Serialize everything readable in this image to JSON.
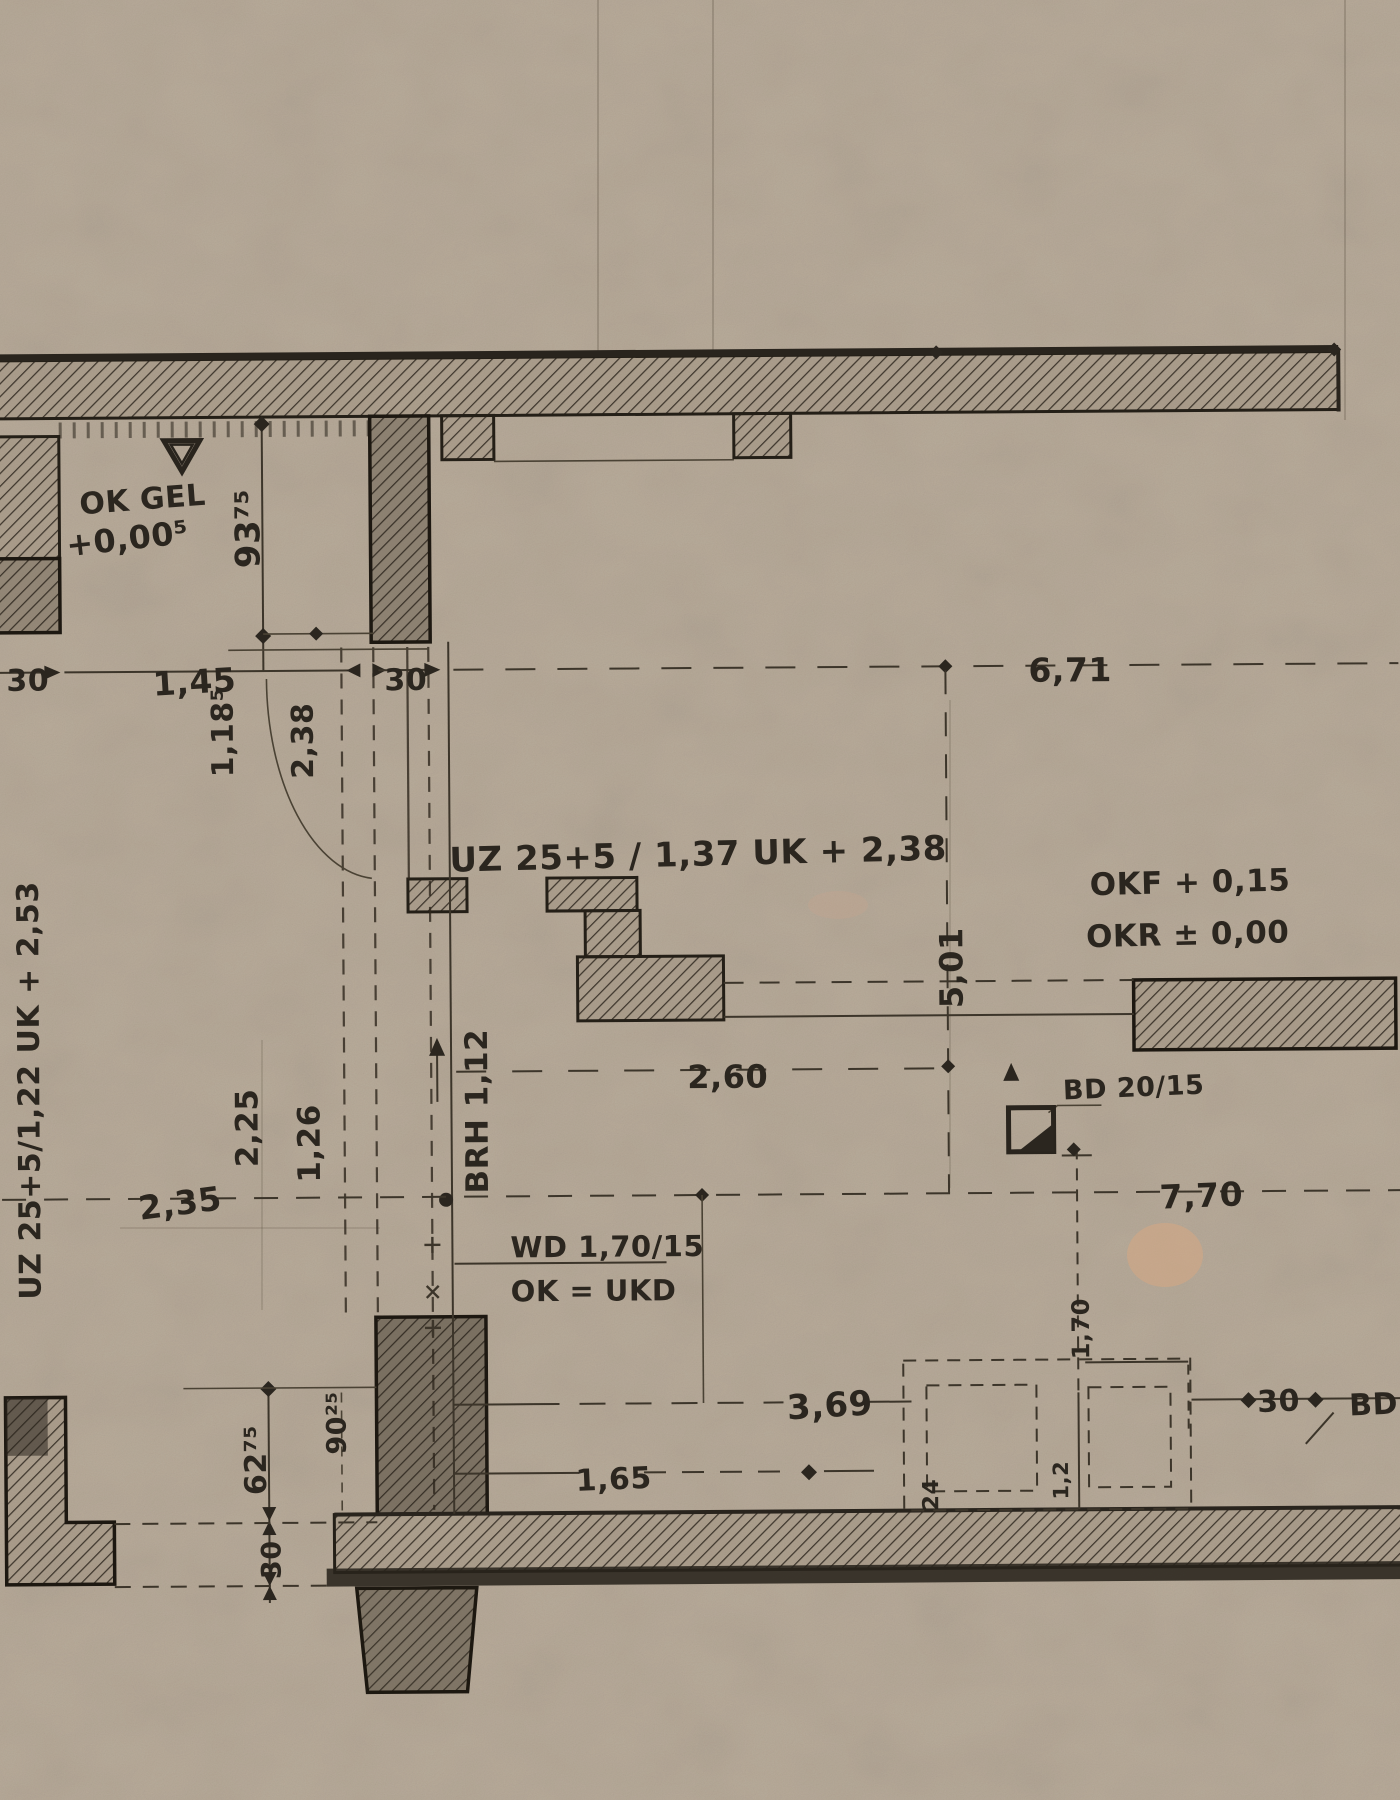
{
  "colors": {
    "paper": "#b6a896",
    "ink": "#29241d",
    "dim_line": "#3c352a",
    "stain": "#dda87f"
  },
  "labels": {
    "levels": {
      "ok_gel": "OK GEL",
      "zero": "+0,00⁵",
      "okf": "OKF + 0,15",
      "okr": "OKR ± 0,00"
    },
    "beams": {
      "uz_top": "UZ 25+5 / 1,37  UK + 2,38",
      "uz_left": "UZ 25+5/1,22  UK + 2,53",
      "wd": "WD 1,70/15",
      "wd_ok": "OK = UKD",
      "bd": "BD 20/15",
      "bd_edge": "BD"
    },
    "dims": {
      "v93": "93⁷⁵",
      "h30_left": "30",
      "h145": "1,45",
      "h30_mid": "30",
      "h671": "6,71",
      "v118": "1,18⁵",
      "v238": "2,38",
      "v501": "5,01",
      "h260": "2,60",
      "brh": "BRH 1,12",
      "v225": "2,25",
      "v126": "1,26",
      "h235": "2,35",
      "h770": "7,70",
      "h369": "3,69",
      "h165": "1,65",
      "v6275": "62⁷⁵",
      "v9025": "90²⁵",
      "v30_bl": "30",
      "v170": "1,70",
      "v12": "1,2",
      "v24": "24",
      "h30_br": "30"
    }
  }
}
